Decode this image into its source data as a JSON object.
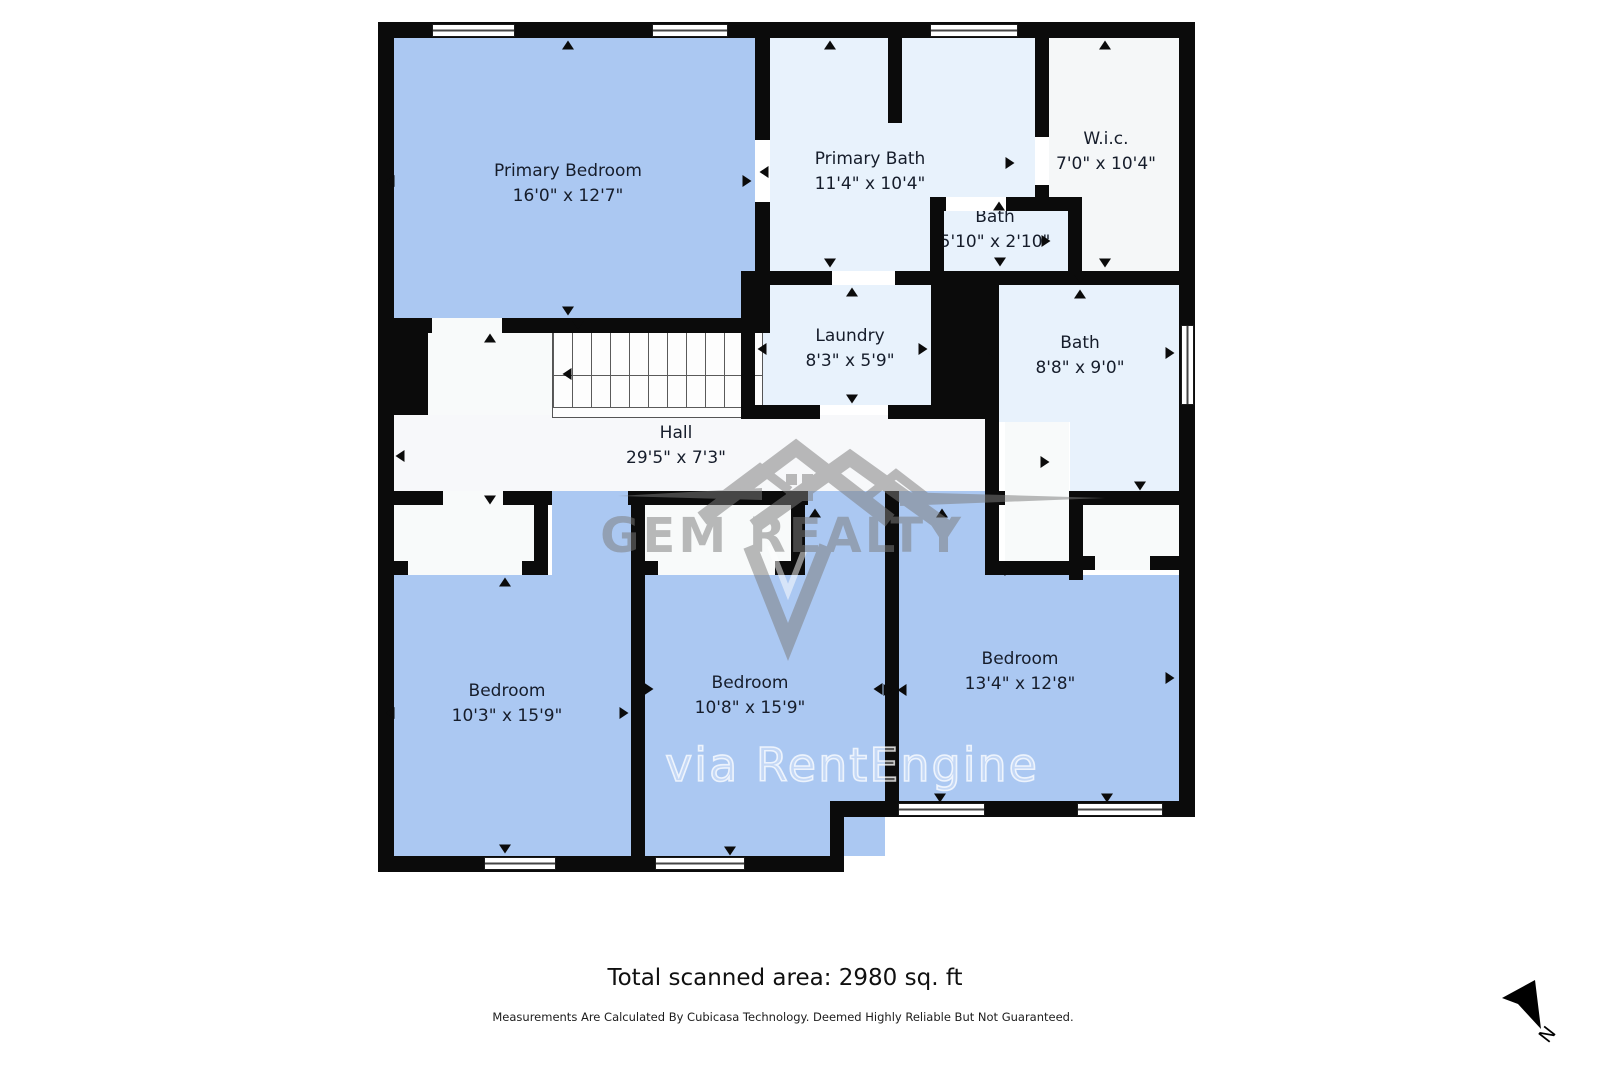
{
  "plan": {
    "rooms": [
      {
        "name": "Primary Bedroom",
        "dims": "16'0\" x 12'7\""
      },
      {
        "name": "Primary Bath",
        "dims": "11'4\" x 10'4\""
      },
      {
        "name": "W.i.c.",
        "dims": "7'0\" x 10'4\""
      },
      {
        "name": "Bath",
        "dims": "5'10\" x 2'10\""
      },
      {
        "name": "Laundry",
        "dims": "8'3\" x 5'9\""
      },
      {
        "name": "Bath",
        "dims": "8'8\" x 9'0\""
      },
      {
        "name": "Hall",
        "dims": "29'5\" x 7'3\""
      },
      {
        "name": "Bedroom",
        "dims": "10'3\" x 15'9\""
      },
      {
        "name": "Bedroom",
        "dims": "10'8\" x 15'9\""
      },
      {
        "name": "Bedroom",
        "dims": "13'4\" x 12'8\""
      }
    ],
    "watermark": {
      "brand": "GEM REALTY",
      "via": "via RentEngine"
    },
    "footer": {
      "total": "Total scanned area: 2980 sq. ft",
      "disclaimer": "Measurements Are Calculated By Cubicasa Technology. Deemed Highly Reliable But Not Guaranteed.",
      "north_label": "N"
    },
    "colors": {
      "bedroom_fill": "#abc8f2",
      "bath_fill": "#e8f2fc",
      "hall_fill": "#f7f8fa",
      "closet_fill": "#f8fafa",
      "wic_fill": "#f5f7f8",
      "wall": "#0b0b0b",
      "watermark_gray": "#7d7d7d"
    }
  }
}
